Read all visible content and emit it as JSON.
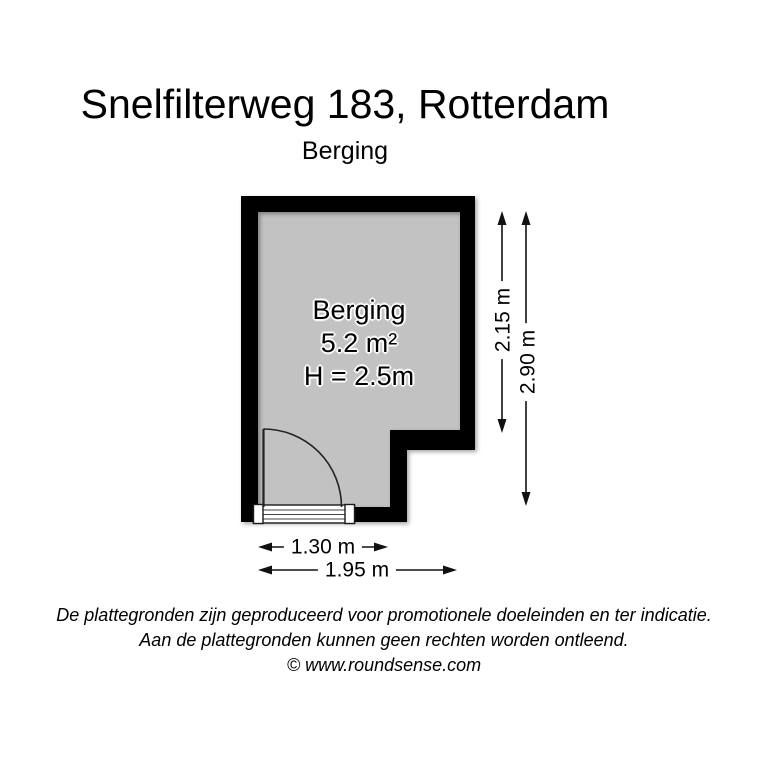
{
  "header": {
    "title": "Snelfilterweg 183, Rotterdam",
    "subtitle": "Berging"
  },
  "floorplan": {
    "room": {
      "name": "Berging",
      "area": "5.2 m²",
      "ceiling_height": "H = 2.5m"
    },
    "dimensions": {
      "vertical_inner": "2.15 m",
      "vertical_outer": "2.90 m",
      "horizontal_inner": "1.30 m",
      "horizontal_outer": "1.95 m"
    }
  },
  "footer": {
    "disclaimer_line1": "De plattegronden zijn geproduceerd voor promotionele doeleinden en ter indicatie.",
    "disclaimer_line2": "Aan de plattegronden kunnen geen rechten worden ontleend.",
    "credit": "© www.roundsense.com"
  },
  "colors": {
    "background": "#ffffff",
    "wall": "#000000",
    "floor": "#c2c2c2",
    "dimension": "#111111",
    "door_symbol": "#222222"
  }
}
